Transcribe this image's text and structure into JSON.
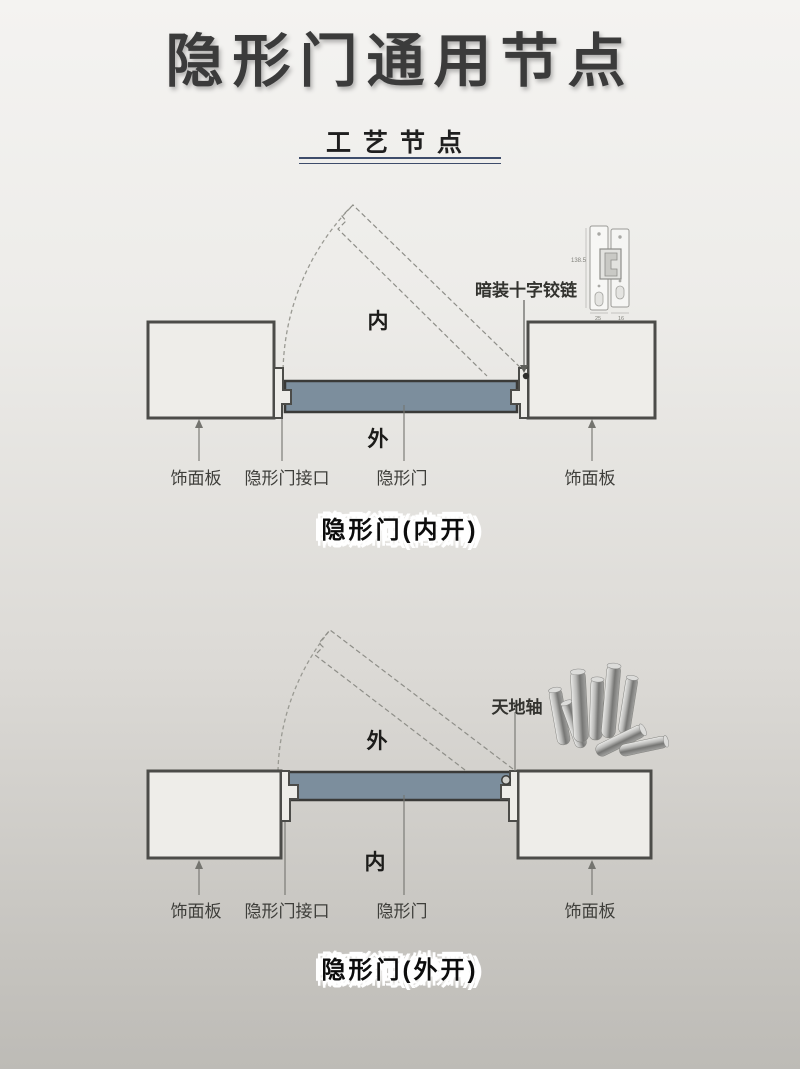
{
  "page": {
    "title": "隐形门通用节点",
    "subtitle": "工艺节点"
  },
  "colors": {
    "background_top": "#f4f3f1",
    "background_bottom": "#bdbbb6",
    "wall_fill": "#eeede9",
    "door_fill": "#7c8e9d",
    "line_dark": "#4c4c49",
    "underline_accent": "#3e4d6b"
  },
  "diagram_inward": {
    "side_inner": "内",
    "side_outer": "外",
    "hardware_label": "暗装十字铰链",
    "hinge_dims": {
      "height": "138.5",
      "a": "25",
      "b": "16"
    },
    "part_labels": [
      "饰面板",
      "隐形门接口",
      "隐形门",
      "饰面板"
    ],
    "caption": "隐形门(内开)"
  },
  "diagram_outward": {
    "side_outer": "外",
    "side_inner": "内",
    "hardware_label": "天地轴",
    "part_labels": [
      "饰面板",
      "隐形门接口",
      "隐形门",
      "饰面板"
    ],
    "caption": "隐形门(外开)"
  }
}
